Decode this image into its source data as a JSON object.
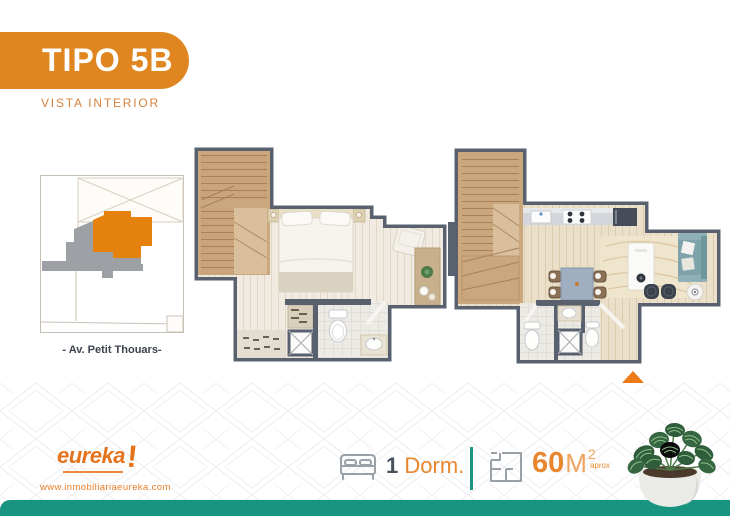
{
  "header": {
    "title": "TIPO 5B",
    "subtitle": "VISTA INTERIOR"
  },
  "sitemap": {
    "street_label": "- Av. Petit Thouars-"
  },
  "footer": {
    "brand": {
      "name": "eureka",
      "exclamation": "!",
      "website": "www.inmobiliariaeureka.com"
    },
    "specs": {
      "bedrooms_value": "1",
      "bedrooms_label": "Dorm.",
      "area_value": "60",
      "area_unit": "M",
      "area_superscript": "2",
      "area_note": "aprox"
    }
  },
  "colors": {
    "accent_orange": "#E08620",
    "logo_orange": "#E5731C",
    "entrance_triangle_orange": "#EC7B17",
    "teal": "#199480",
    "wall_gray": "#59616F",
    "site_unit_orange": "#E5820E",
    "site_building_gray": "#9DA1A5"
  }
}
